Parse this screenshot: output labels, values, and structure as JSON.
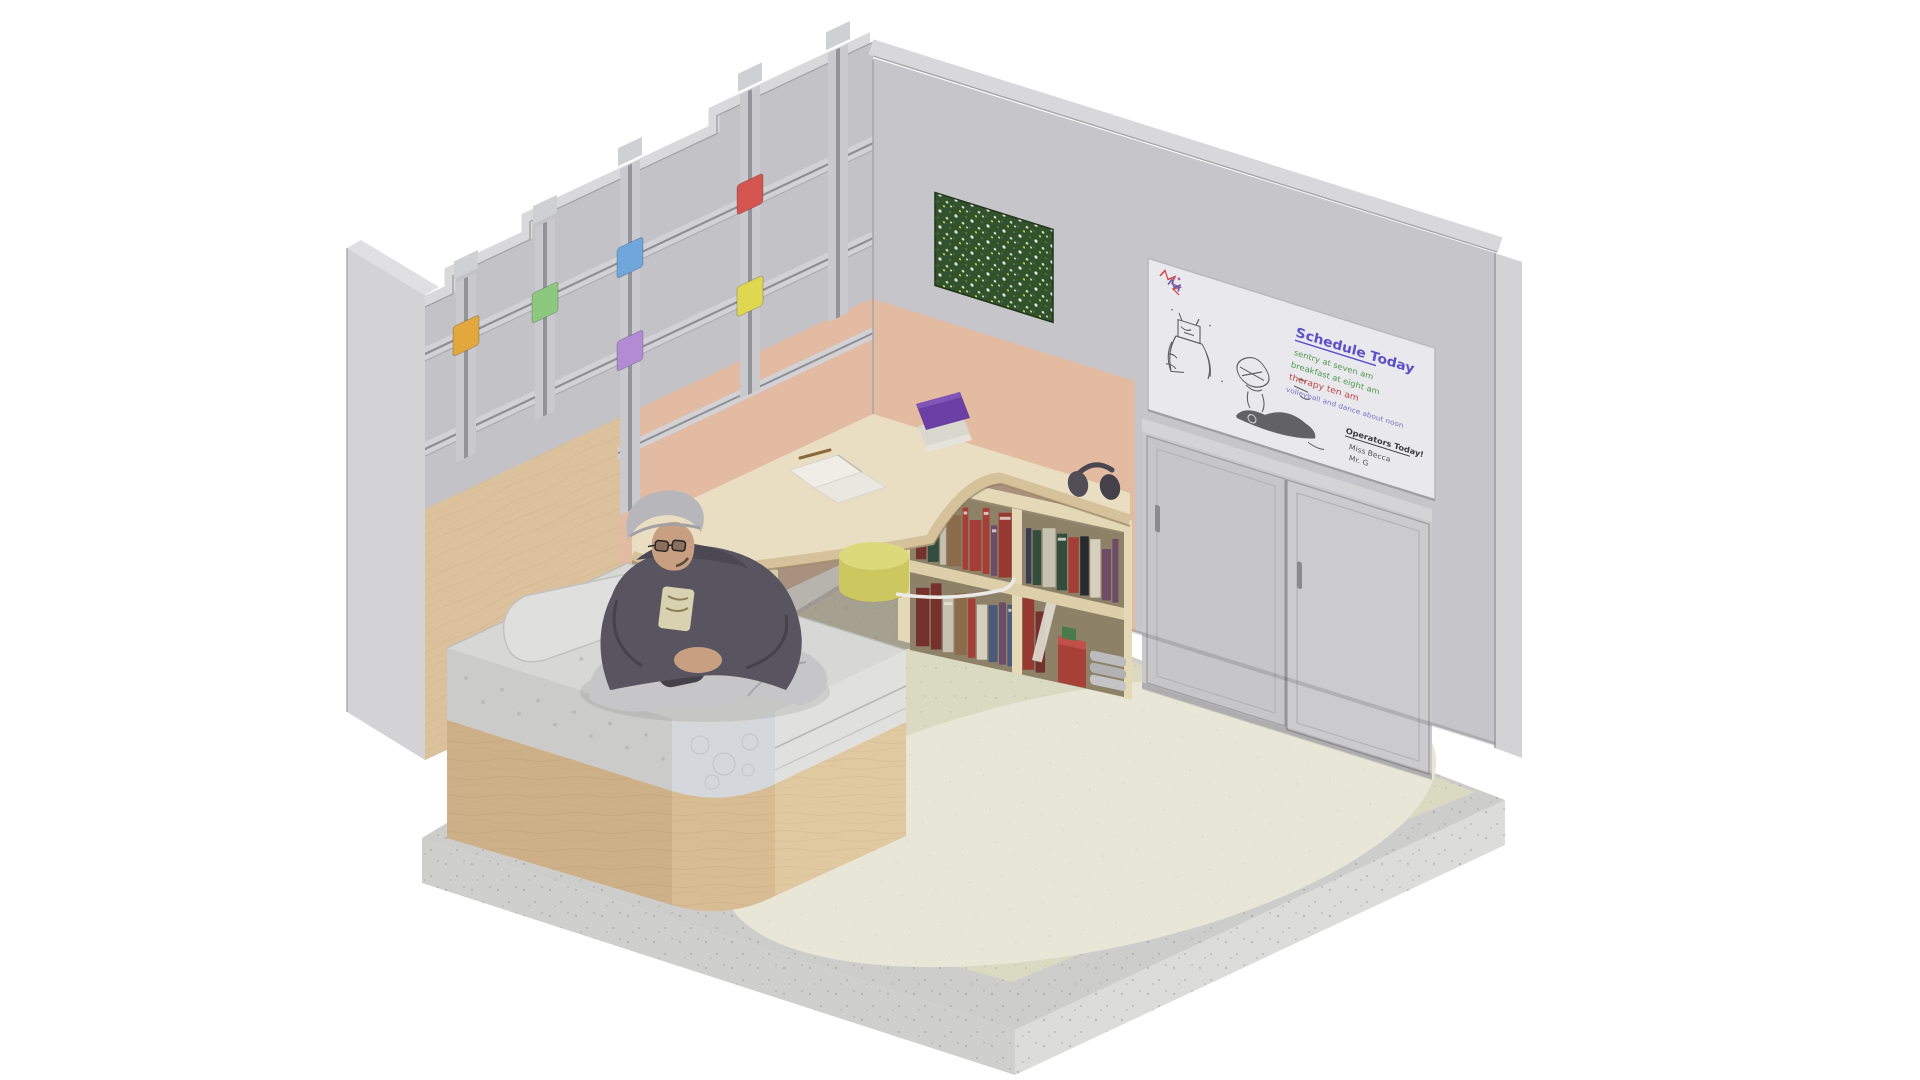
{
  "meta": {
    "title": "Isometric bedroom cutaway render",
    "type": "3d-isometric-room",
    "background": "#ffffff"
  },
  "palette": {
    "wall_gray": "#c3c3c7",
    "wall_gray_right": "#c6c6ca",
    "wall_top": "#d9d9db",
    "plinth": "#cdcdcb",
    "floor": "#dad9c2",
    "rug": "#e8e6d6",
    "plywood": "#dcc29c",
    "peach": "#e2bba2",
    "desk": "#e9dec2",
    "mattress": "#d7d7d5",
    "bed_wood": "#cdb087",
    "wardrobe": "#c9c9cb",
    "whiteboard": "#e9e9ed",
    "plant": "#2c4a26",
    "stool": "#dcd97b"
  },
  "left_wall": {
    "description": "stepped gray panel wall with mounting rails and colored clips",
    "clips": [
      {
        "name": "amber",
        "color": "#e2a83e"
      },
      {
        "name": "green",
        "color": "#8cc97e"
      },
      {
        "name": "blue",
        "color": "#6fa7dc"
      },
      {
        "name": "purple",
        "color": "#b28bd4"
      },
      {
        "name": "red",
        "color": "#d45450"
      },
      {
        "name": "yellow",
        "color": "#ded74f"
      }
    ],
    "rails": 3,
    "channels": 5
  },
  "whiteboard": {
    "title": "Schedule Today",
    "title_color": "#5b50c8",
    "schedule": [
      {
        "text": "sentry at seven am",
        "color": "#4e9a4e"
      },
      {
        "text": "breakfast at eight am",
        "color": "#4e9a4e"
      },
      {
        "text": "therapy ten am",
        "color": "#c24848"
      },
      {
        "text": "volleyball and dance about noon",
        "color": "#7b74c9"
      }
    ],
    "operators_title": "Operators Today!",
    "operators": [
      "Miss Becca",
      "Mr. G"
    ],
    "doodles": [
      "colorful scribble",
      "box-headed figure sketch",
      "scribble figure",
      "dark marker blob"
    ]
  },
  "right_wall": {
    "plant_art": "greenery wall panel",
    "wardrobe": {
      "doors": 2,
      "handles": 2
    }
  },
  "furniture": {
    "bed": "platform bed, tufted mattress, rounded wood base",
    "pillow": "pillow",
    "desk": "curved corner desk",
    "notebook": "open notebook with pencil",
    "books_on_desk": "purple book stack",
    "towels": "rolled towels in cubby",
    "stool": "round yellow stool",
    "bookshelf": "two-row bookshelf",
    "headphones": "headphones on shelf top",
    "blankets": "folded gray blankets",
    "red_box": "red storage box",
    "cable": "white cable"
  },
  "person": {
    "pose": "young man sitting cross-legged on the bed",
    "clothing": [
      "gray beanie",
      "glasses",
      "dark gray hoodie with graphic",
      "light gray sweatpants",
      "dark shoes"
    ]
  },
  "book_palette": [
    "#343a52",
    "#742e2a",
    "#c8c3b4",
    "#2e4a3c",
    "#8a6a49",
    "#22262c",
    "#a43b35",
    "#d8d2c2",
    "#49597a",
    "#6b4a68",
    "#97362f",
    "#50555f"
  ]
}
